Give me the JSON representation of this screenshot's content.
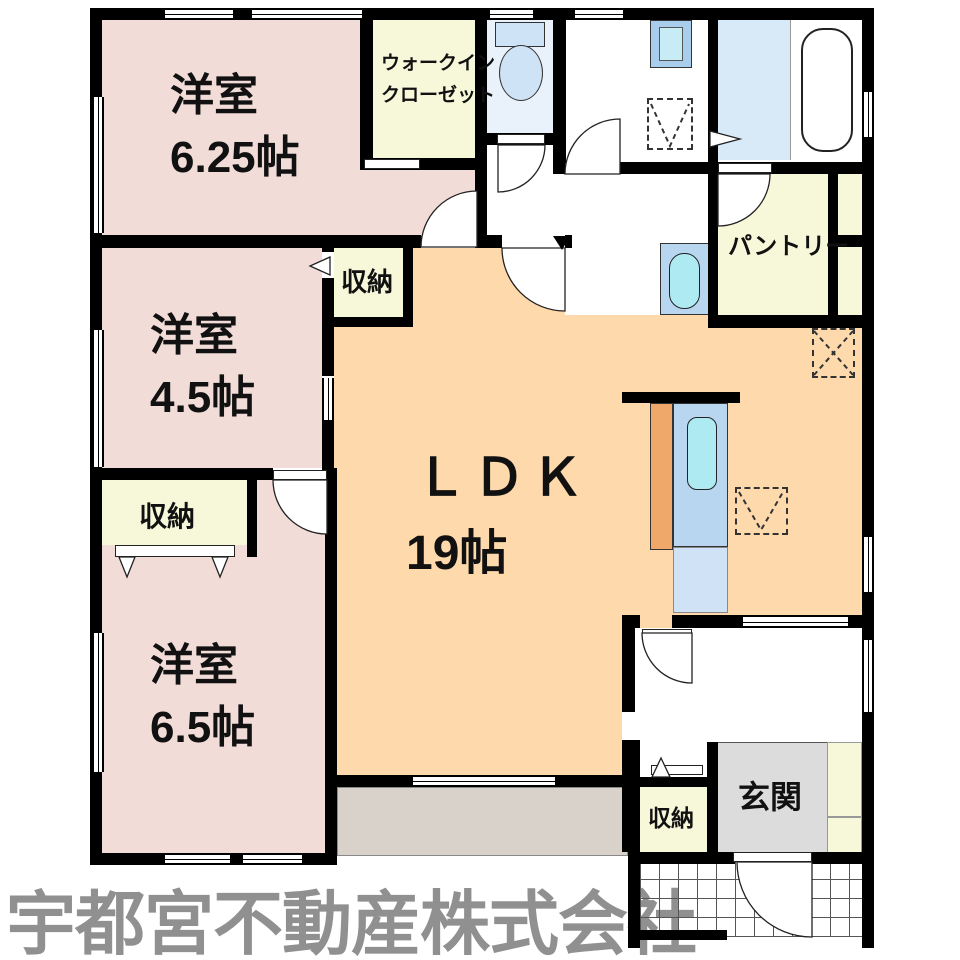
{
  "floorplan": {
    "rooms": {
      "youshitsu_625": {
        "label": "洋室",
        "size": "6.25帖"
      },
      "walk_in_closet": {
        "label_line1": "ウォークイン",
        "label_line2": "クローゼット"
      },
      "youshitsu_45": {
        "label": "洋室",
        "size": "4.5帖"
      },
      "youshitsu_65": {
        "label": "洋室",
        "size": "6.5帖"
      },
      "ldk": {
        "label": "ＬＤＫ",
        "size": "19帖"
      },
      "pantry": {
        "label": "パントリー"
      },
      "genkan": {
        "label": "玄関"
      },
      "closet_top": {
        "label": "収納"
      },
      "closet_left": {
        "label": "収納"
      },
      "closet_hall": {
        "label": "収納"
      }
    },
    "watermark": "宇都宮不動産株式会社",
    "colors": {
      "room_pink": "#f2dcd8",
      "ldk_orange": "#fed9ab",
      "closet_yellow": "#f7f7da",
      "bath_blue": "#d8eaf8",
      "toilet_blue": "#e9f1fb",
      "fixture_blue": "#b9d6f1",
      "fixture_blue_light": "#cfe2f6",
      "sink_cyan": "#aeeaf2",
      "counter_orange": "#efa86a",
      "genkan_gray": "#dcdcdc",
      "terrace_gray": "#d8d2cb",
      "watermark_gray": "#909090",
      "wall_black": "#000000"
    }
  }
}
